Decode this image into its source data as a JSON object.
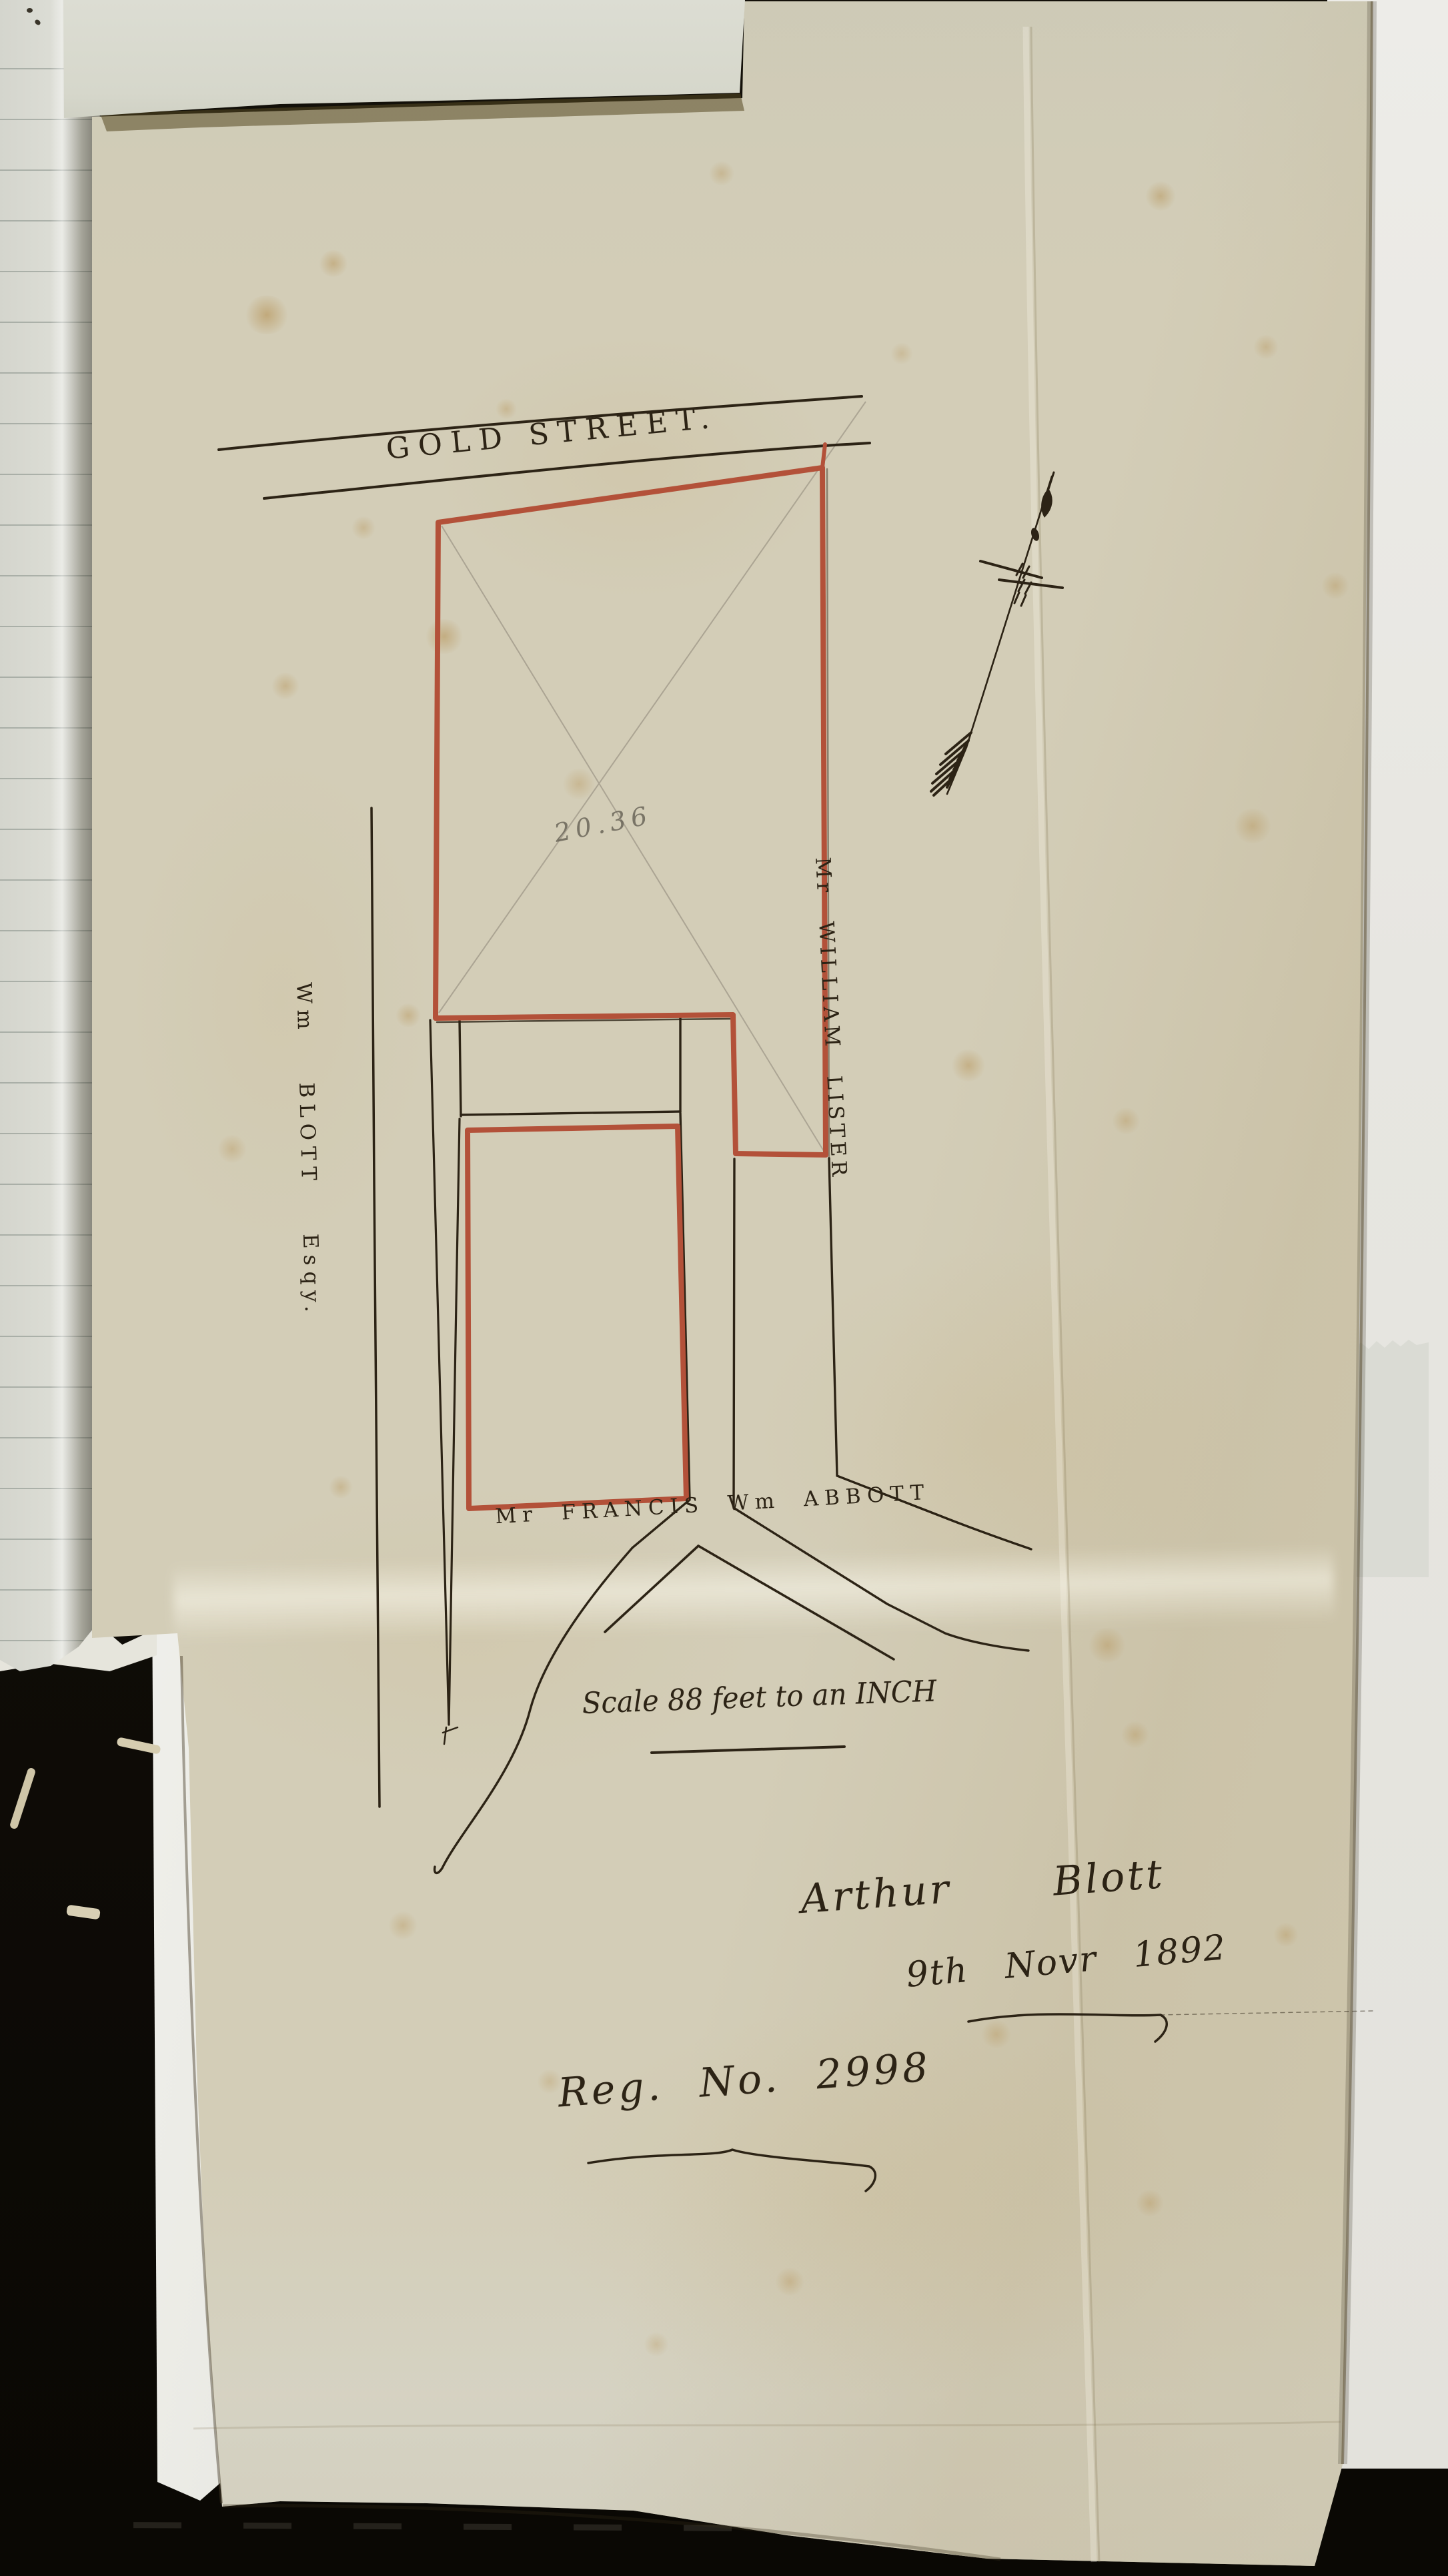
{
  "page": {
    "street_label": "GOLD STREET.",
    "pencil_dimension": "20.36",
    "owner_east": "Mr WILLIAM LISTER",
    "owner_west": "Wm BLOTT Esqy.",
    "owner_south": "Mr FRANCIS Wm ABBOTT",
    "scale_note": "Scale 88 feet to an INCH",
    "signature": {
      "name": "Arthur Blott",
      "date": "9th Novr 1892"
    },
    "registration_number": "Reg. No. 2998",
    "colors": {
      "plot_outline_red": "#b35139",
      "ink": "#2c2315",
      "pencil": "#9b9484",
      "parchment": "#d3cdb7"
    }
  }
}
